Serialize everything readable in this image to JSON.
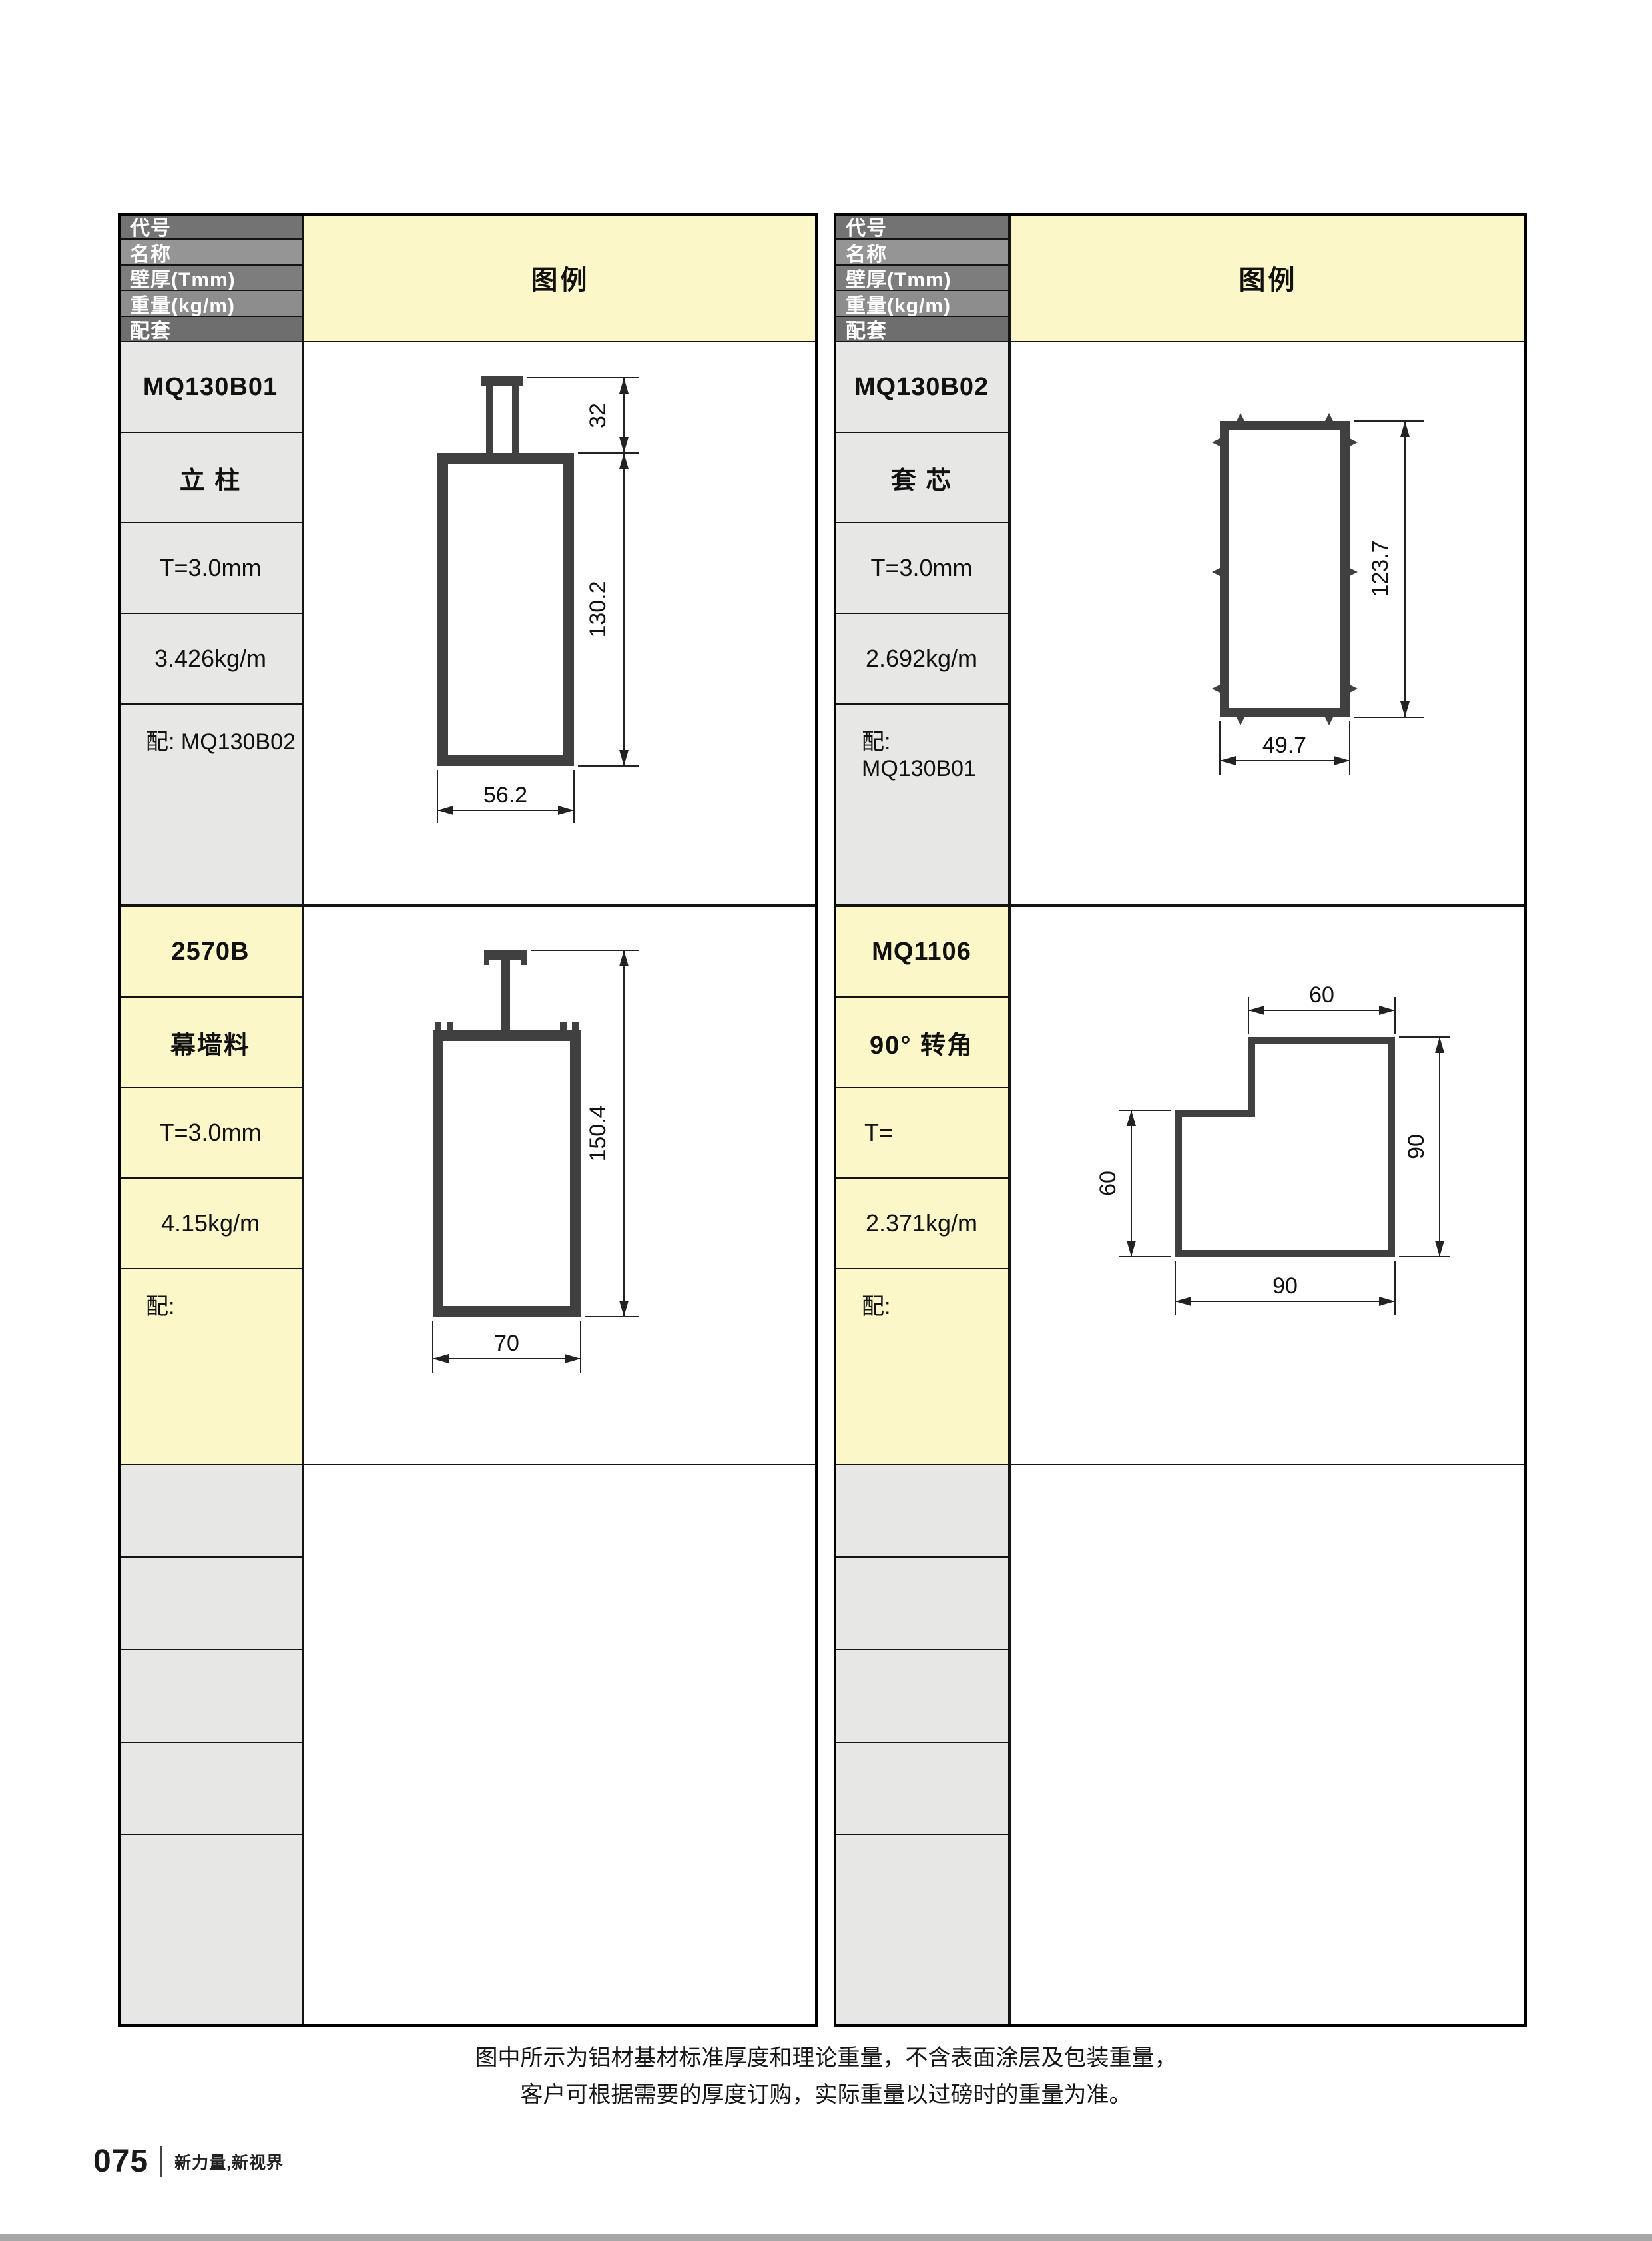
{
  "header_labels": {
    "code": "代号",
    "name": "名称",
    "thickness": "壁厚(Tmm)",
    "weight": "重量(kg/m)",
    "match": "配套",
    "legend": "图例"
  },
  "products": [
    {
      "code": "MQ130B01",
      "name": "立 柱",
      "thickness": "T=3.0mm",
      "weight": "3.426kg/m",
      "match": "配: MQ130B02",
      "dims": {
        "stub_height": "32",
        "body_height": "130.2",
        "width": "56.2"
      }
    },
    {
      "code": "MQ130B02",
      "name": "套 芯",
      "thickness": "T=3.0mm",
      "weight": "2.692kg/m",
      "match": "配: MQ130B01",
      "dims": {
        "height": "123.7",
        "width": "49.7"
      }
    },
    {
      "code": "2570B",
      "name": "幕墙料",
      "thickness": "T=3.0mm",
      "weight": "4.15kg/m",
      "match": "配:",
      "dims": {
        "height": "150.4",
        "width": "70"
      }
    },
    {
      "code": "MQ1106",
      "name": "90° 转角",
      "thickness": "T=",
      "weight": "2.371kg/m",
      "match": "配:",
      "dims": {
        "top": "60",
        "right": "90",
        "left": "60",
        "bottom": "90"
      }
    }
  ],
  "note": {
    "line1": "图中所示为铝材基材标准厚度和理论重量，不含表面涂层及包装重量，",
    "line2": "客户可根据需要的厚度订购，实际重量以过磅时的重量为准。"
  },
  "footer": {
    "page_number": "075",
    "slogan": "新力量,新视界"
  },
  "colors": {
    "legend_yellow": "#fbf7c9",
    "label_gray": "#e7e7e5",
    "profile_wall": "#404040",
    "header_gray": "#7d7d7d",
    "bottom_bar": "#a7a7a7"
  }
}
